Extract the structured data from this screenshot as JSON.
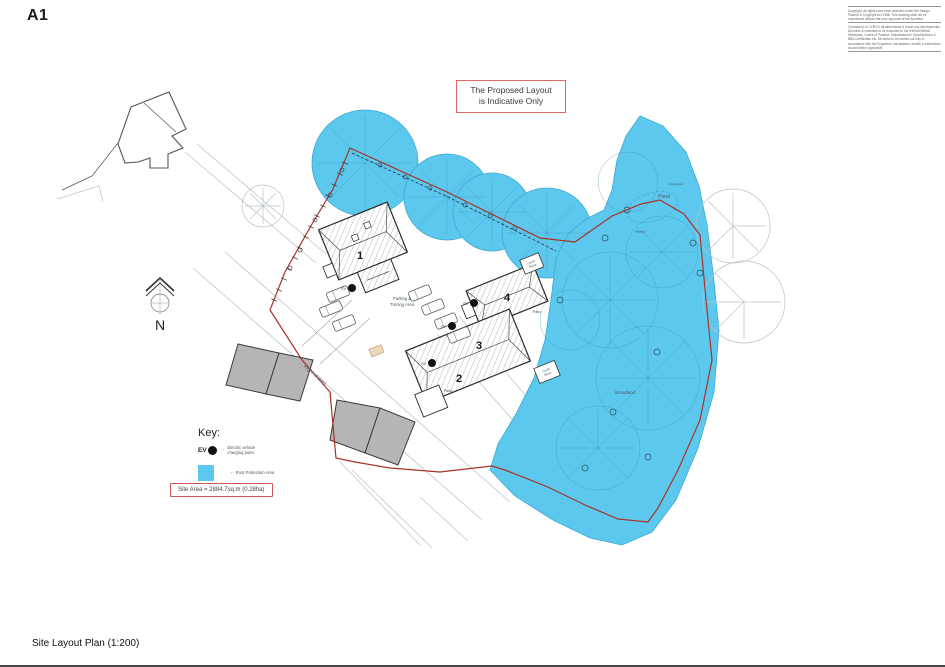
{
  "sheet": {
    "size_label": "A1",
    "footer_title": "Site Layout Plan (1:200)",
    "copyright_note_1": "Copyright. All rights have been asserted under the Design Patents & Copyright Act 1988. This drawing shall not be reproduced without the prior approval of the Architect.",
    "copyright_note_2": "Contractors to CHECK all dimensions & report any discrepancies. All works & materials to be executed to the relevant British Standards, Codes of Practice, Manufacturers' Specifications & BBA Certificates etc. All works to be carried out fully in accordance with the Engineers' calculations, details & instructions as and where applicable."
  },
  "notice": {
    "line1": "The Proposed Layout",
    "line2": "is Indicative Only"
  },
  "key": {
    "heading": "Key:",
    "bullet": "-",
    "ev_abbr": "EV",
    "ev_label_line1": "Electric vehicle",
    "ev_label_line2": "charging point",
    "rpa_label": "Root Protection Area"
  },
  "site_area": {
    "label": "Site Area = 2884.7sq.m (0.28ha)"
  },
  "plan": {
    "north_label": "N",
    "buildings": {
      "b1": "1",
      "b2": "2",
      "b3": "3",
      "b4": "4"
    },
    "labels": {
      "parking_line1": "Parking &",
      "parking_line2": "Turning Area",
      "right_of_way": "Right of Way",
      "pond_upper": "Overgrown",
      "pond": "Pond",
      "pond_lower": "Pond",
      "woodland": "Woodland",
      "cycle_line1": "Cycle",
      "cycle_line2": "Store",
      "patio": "Patio",
      "ev": "EV"
    }
  },
  "colors": {
    "root_protection_cyan": "#5cc8ee",
    "tree_detail_blue": "#3aa9d2",
    "boundary_red": "#a93226",
    "notice_box_red": "#e06666",
    "existing_building_gray": "#b5b5b5"
  }
}
